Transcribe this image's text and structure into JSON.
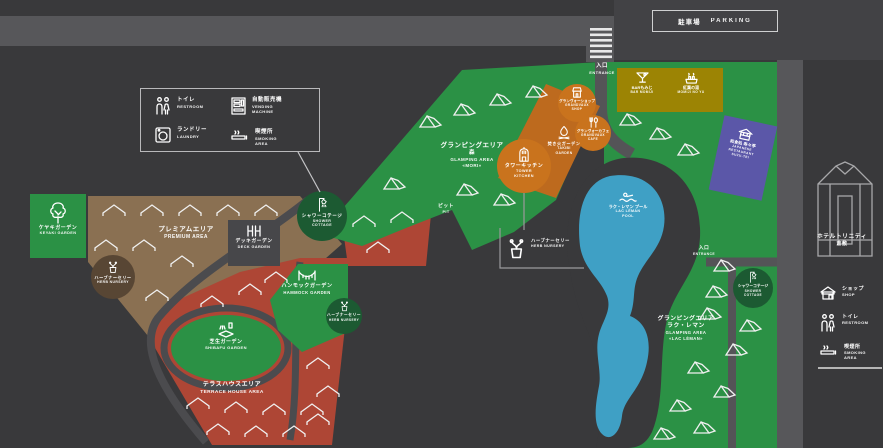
{
  "palette": {
    "bg": "#39393b",
    "road": "#57575a",
    "green": "#2b9145",
    "dark_green": "#1c5a32",
    "brown": "#8a7052",
    "dark_brown": "#584634",
    "red": "#ae4635",
    "olive": "#9c8404",
    "orange": "#bd6a1e",
    "orange_circle": "#c9731d",
    "purple": "#5b57a8",
    "pool": "#3fa0c5"
  },
  "parking": {
    "jp": "駐車場",
    "en": "PARKING"
  },
  "entrance": {
    "jp": "入口",
    "en": "ENTRANCE"
  },
  "legend_left": {
    "items": [
      {
        "jp": "トイレ",
        "en": "RESTROOM",
        "icon": "restroom-icon"
      },
      {
        "jp": "自動販売機",
        "en": "VENDING MACHINE",
        "icon": "vending-machine-icon"
      },
      {
        "jp": "ランドリー",
        "en": "LAUNDRY",
        "icon": "laundry-icon"
      },
      {
        "jp": "喫煙所",
        "en": "SMOKING AREA",
        "icon": "smoking-icon"
      }
    ]
  },
  "legend_right": {
    "items": [
      {
        "jp": "ショップ",
        "en": "SHOP",
        "icon": "shop-icon"
      },
      {
        "jp": "トイレ",
        "en": "RESTROOM",
        "icon": "restroom-icon"
      },
      {
        "jp": "喫煙所",
        "en": "SMOKING AREA",
        "icon": "smoking-icon"
      }
    ]
  },
  "areas": {
    "keyaki": {
      "jp": "ケヤキガーデン",
      "en": "KEYAKI GARDEN"
    },
    "premium": {
      "jp": "プレミアムエリア",
      "en": "PREMIUM AREA"
    },
    "deck": {
      "jp": "デッキガーデン",
      "en": "DECK GARDEN"
    },
    "herb": {
      "jp": "ハーブナーセリー",
      "en": "HERB NURSERY"
    },
    "hammock": {
      "jp": "ハンモックガーデン",
      "en": "HAMMOCK GARDEN"
    },
    "shibafu": {
      "jp": "芝生ガーデン",
      "en": "SHIBAFU GARDEN"
    },
    "terrace": {
      "jp": "テラスハウスエリア",
      "en": "TERRACE HOUSE AREA"
    },
    "shower": {
      "jp": "シャワーコテージ",
      "en1": "SHOWER",
      "en2": "COTTAGE"
    },
    "mori": {
      "jp1": "グランピングエリア",
      "jp2": "森",
      "en1": "GLAMPING AREA",
      "en2": "«MORI»"
    },
    "tower": {
      "jp": "タワーキッチン",
      "en1": "TOWER",
      "en2": "KITCHEN"
    },
    "takibi": {
      "jp": "焚き火ガーデン",
      "en1": "TAKIBI",
      "en2": "GARDEN"
    },
    "gv_shop": {
      "jp": "グランヴォーショップ",
      "en1": "GRANDVAUX",
      "en2": "SHOP"
    },
    "gv_cafe": {
      "jp": "グランヴォーカフェ",
      "en1": "GRANDVAUX",
      "en2": "CAFE"
    },
    "pit": {
      "jp": "ピット",
      "en": "PIT"
    },
    "bar": {
      "jp": "BARもみじ",
      "en": "BAR MOMIJI"
    },
    "ashiyu": {
      "jp": "紅葉の湯",
      "en": "MOMIJI NO YU"
    },
    "restaurant": {
      "jp": "和食処 寿々亭",
      "en1": "JAPANESE",
      "en2": "RESTAURANT",
      "en3": "SUZU-TEI"
    },
    "pool": {
      "jp": "ラク・レマン プール",
      "en1": "LAC LÉMAN",
      "en2": "POOL"
    },
    "lacleman": {
      "jp1": "グランピングエリア",
      "jp2": "ラク・レマン",
      "en1": "GLAMPING AREA",
      "en2": "«LAC LÉMAN»"
    }
  },
  "hotel": {
    "jp1": "ホテルトリニティ",
    "jp2": "倉敷"
  }
}
